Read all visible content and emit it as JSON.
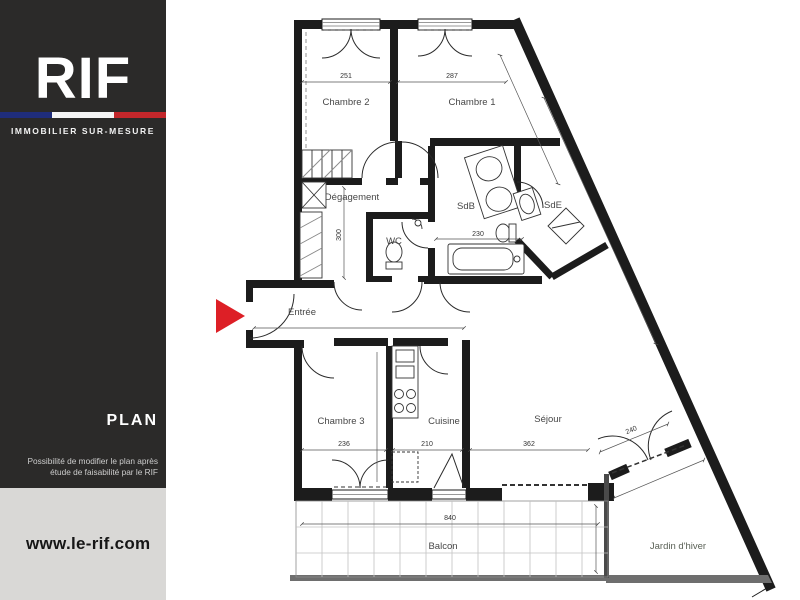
{
  "sidebar": {
    "logo_text": "RIF",
    "tagline": "IMMOBILIER SUR-MESURE",
    "plan_label": "PLAN",
    "note_line1": "Possibilité de modifier le plan après",
    "note_line2": "étude de faisabilité par le RIF",
    "website": "www.le-rif.com"
  },
  "colors": {
    "sidebar_bg": "#2b2a29",
    "flag_blue": "#1f2d7b",
    "flag_white": "#f5f5f5",
    "flag_red": "#c3272b",
    "footer_bg": "#d9d8d6",
    "entrance_arrow": "#dd1f26",
    "plan_lines": "#1c1c1c"
  },
  "plan": {
    "rooms": [
      {
        "id": "chambre2",
        "label": "Chambre 2"
      },
      {
        "id": "chambre1",
        "label": "Chambre 1"
      },
      {
        "id": "degagement",
        "label": "Dégagement"
      },
      {
        "id": "sdb",
        "label": "SdB"
      },
      {
        "id": "sde",
        "label": "SdE"
      },
      {
        "id": "wc",
        "label": "WC"
      },
      {
        "id": "entree",
        "label": "Entrée"
      },
      {
        "id": "chambre3",
        "label": "Chambre 3"
      },
      {
        "id": "cuisine",
        "label": "Cuisine"
      },
      {
        "id": "sejour",
        "label": "Séjour"
      },
      {
        "id": "balcon",
        "label": "Balcon"
      },
      {
        "id": "jardin",
        "label": "Jardin d'hiver"
      }
    ],
    "dimensions": {
      "chambre2_width": "251",
      "chambre1_width": "287",
      "chambre3_width": "236",
      "cuisine_width": "210",
      "sejour_width": "362",
      "balcon_width": "840",
      "bathtub_width": "230",
      "degagement_height": "300",
      "jardin_door_width": "240"
    }
  }
}
